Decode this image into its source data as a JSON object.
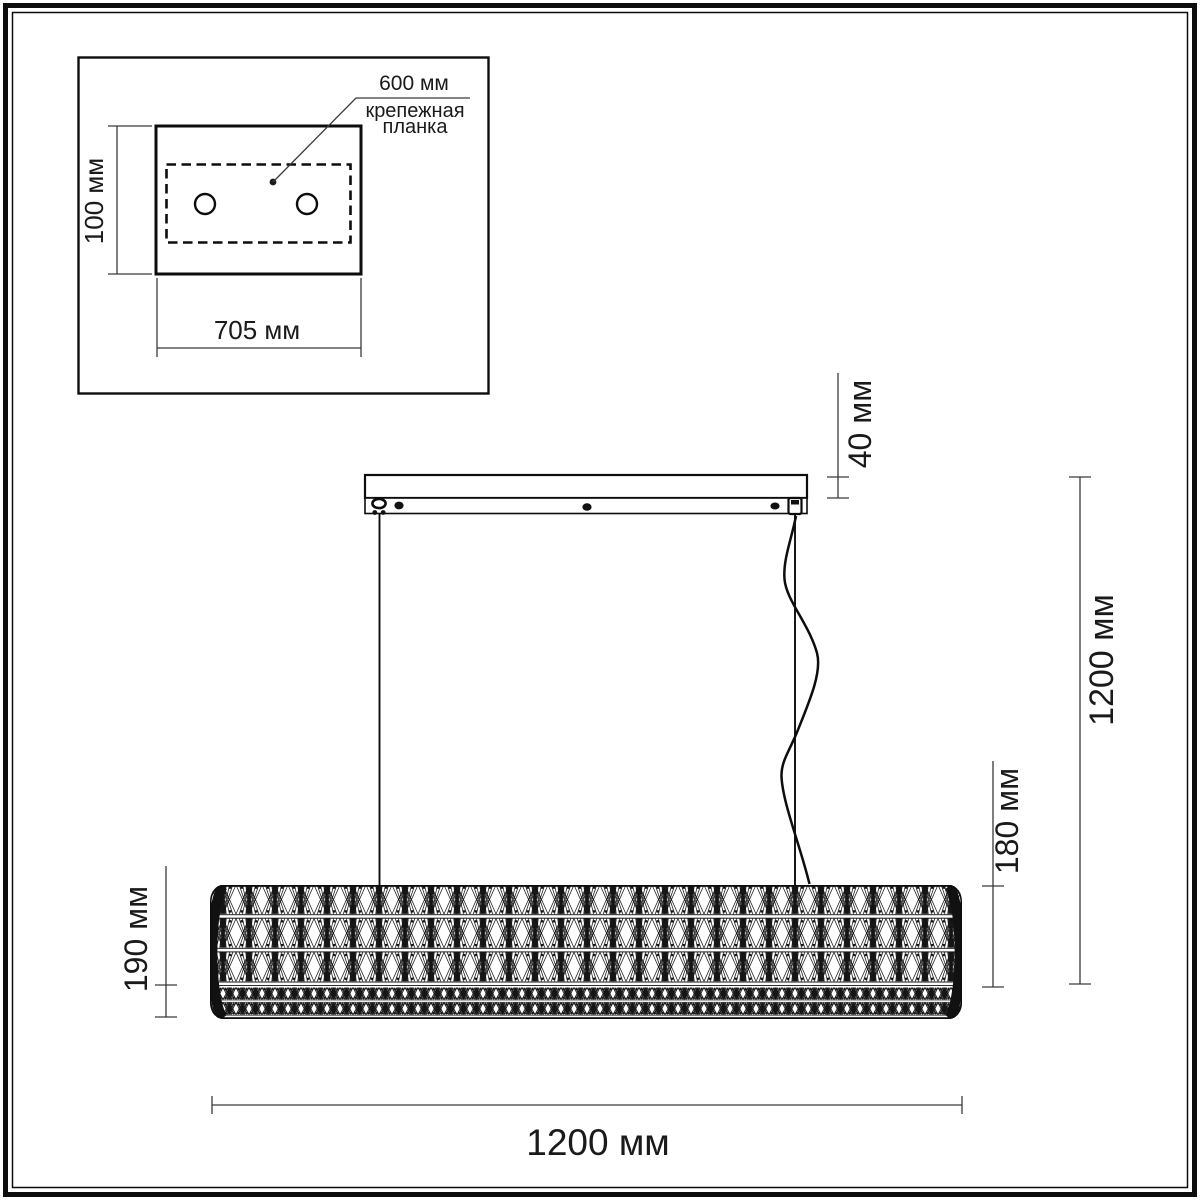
{
  "drawing": {
    "inset": {
      "bracket_length": "600 мм",
      "bracket_name_line1": "крепежная",
      "bracket_name_line2": "планка",
      "plate_height": "100 мм",
      "plate_width": "705 мм"
    },
    "dimensions": {
      "canopy_height": "40 мм",
      "overall_height": "1200 мм",
      "shade_body_height": "180 мм",
      "shade_total_height": "190 мм",
      "overall_width": "1200 мм"
    },
    "colors": {
      "line": "#1a1a1a",
      "dim_line": "#3a3a3a",
      "background": "#ffffff"
    }
  }
}
